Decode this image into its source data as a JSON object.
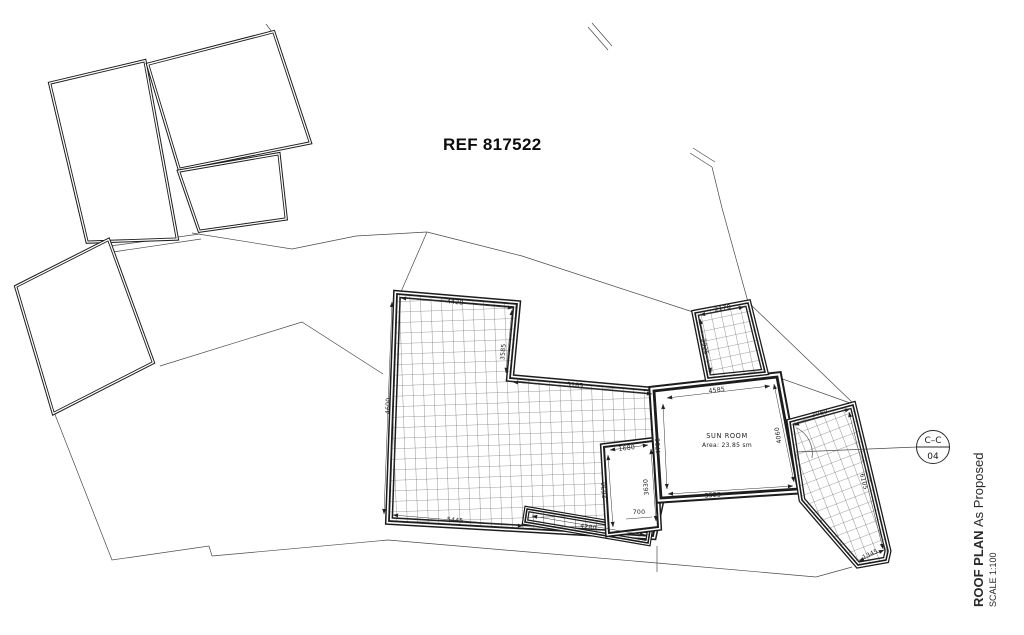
{
  "drawing": {
    "ref_label": "REF 817522",
    "sun_room": {
      "name": "SUN ROOM",
      "area": "Area: 23.85 sm"
    },
    "section_marker": {
      "label": "C–C",
      "number": "04"
    },
    "title_block": {
      "title": "ROOF PLAN",
      "status": "As Proposed",
      "scale": "SCALE 1:100"
    },
    "dimensions": {
      "main_top": "4420",
      "main_right": "3585",
      "main_left": "4600",
      "main_diagonal": "5185",
      "main_bottom": "5445",
      "lower_strip": "4280",
      "stair_top": "1680",
      "stair_left": "2630",
      "stair_right": "3630",
      "stair_offset": "700",
      "sunroom_top": "4585",
      "sunroom_left": "4750",
      "sunroom_bottom": "5525",
      "sunroom_right": "4060",
      "nook_top": "2170",
      "nook_left": "2925",
      "wing_top": "2080",
      "wing_right": "6105",
      "wing_bottom": "1345"
    }
  }
}
